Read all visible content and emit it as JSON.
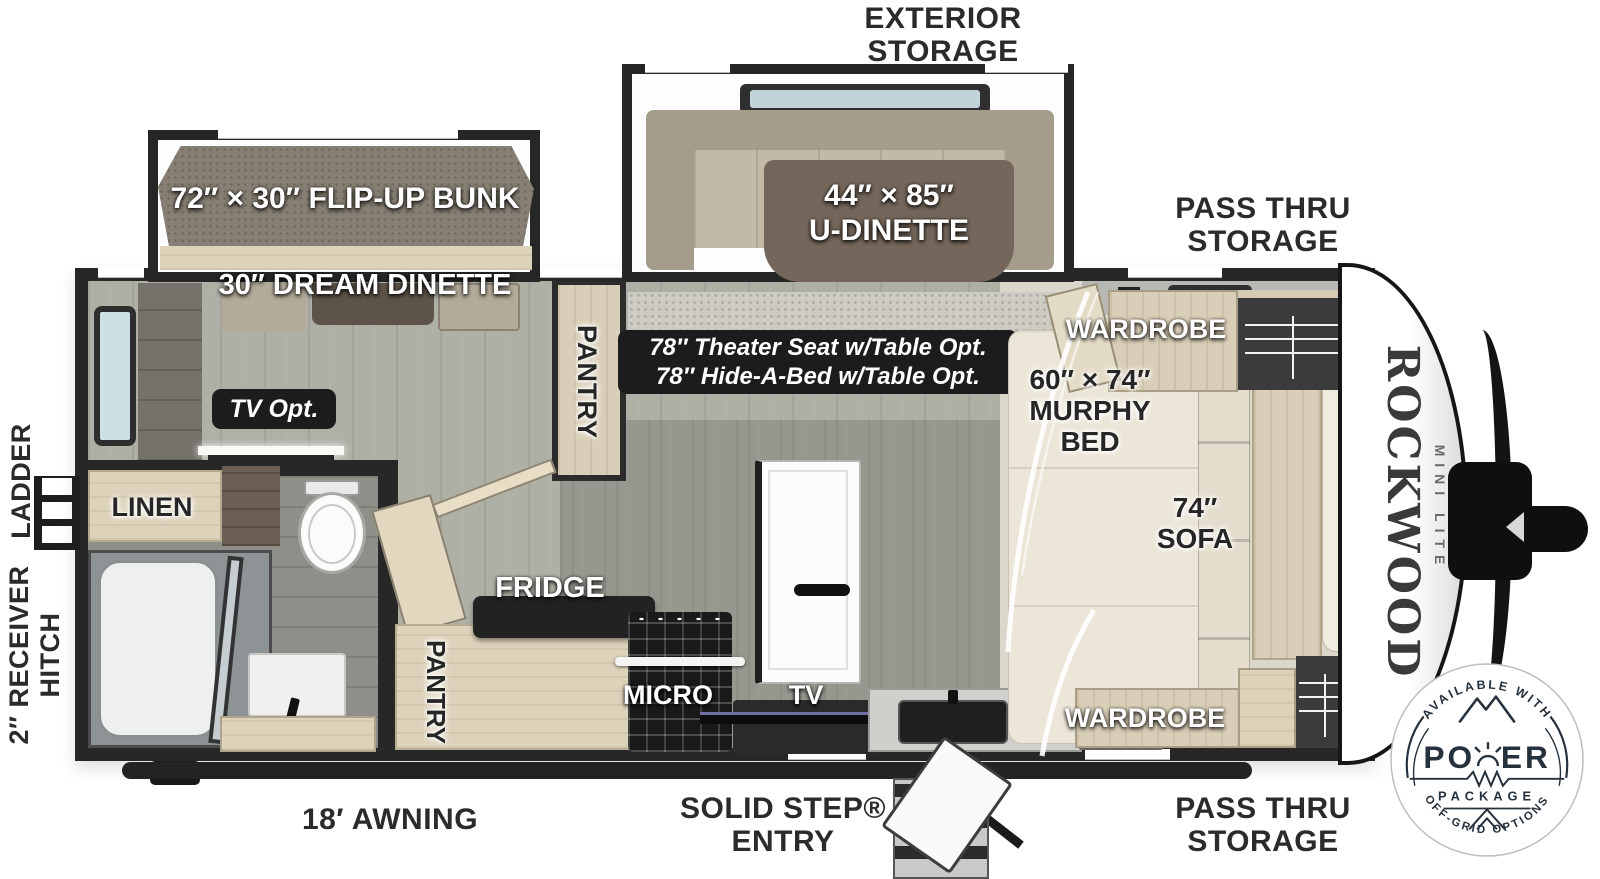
{
  "outside_labels": {
    "exterior_storage": {
      "line1": "EXTERIOR",
      "line2": "STORAGE"
    },
    "pass_thru_top": {
      "line1": "PASS THRU",
      "line2": "STORAGE"
    },
    "pass_thru_bottom": {
      "line1": "PASS THRU",
      "line2": "STORAGE"
    },
    "awning": "18′ AWNING",
    "solid_step": {
      "line1": "SOLID STEP®",
      "line2": "ENTRY"
    },
    "ladder": "LADDER",
    "receiver_hitch": {
      "line1": "2″ RECEIVER",
      "line2": "HITCH"
    }
  },
  "interior_labels": {
    "flip_up_bunk": "72″ × 30″ FLIP-UP BUNK",
    "dream_dinette": "30″ DREAM DINETTE",
    "u_dinette": {
      "line1": "44″ × 85″",
      "line2": "U-DINETTE"
    },
    "options_badge": {
      "line1": "78″ Theater Seat w/Table Opt.",
      "line2": "78″ Hide-A-Bed w/Table Opt."
    },
    "tv_opt": "TV Opt.",
    "pantry_main": "PANTRY",
    "pantry_kitchen": "PANTRY",
    "linen": "LINEN",
    "fridge": "FRIDGE",
    "micro": "MICRO",
    "tv": "TV",
    "wardrobe_top": "WARDROBE",
    "wardrobe_bottom": "WARDROBE",
    "murphy_bed": {
      "line1": "60″ × 74″",
      "line2": "MURPHY",
      "line3": "BED"
    },
    "sofa": {
      "line1": "74″",
      "line2": "SOFA"
    },
    "shelf": "SHELF"
  },
  "brand": {
    "name": "ROCKWOOD",
    "series": "MINI LITE"
  },
  "power_badge": {
    "top_arc": "AVAILABLE WITH",
    "word": "POWER",
    "word_left": "PO",
    "word_right": "ER",
    "sub": "PACKAGE",
    "bottom_arc": "OFF-GRID OPTIONS"
  },
  "colors": {
    "wall": "#272727",
    "label_dark": "#2b2b2b",
    "badge_bg": "#1c1c1c",
    "wood_light": "#ddd3bb",
    "cushion": "#b3aa99",
    "table_brown": "#74665a",
    "mattress_gray": "#8a8177",
    "floor_living": "#aeb0a6",
    "floor_bath": "#8e8f88",
    "carpet_bedroom": "#dbd7ca",
    "glass_blue": "#c2d4da",
    "bed_cream": "#ece6d8",
    "badge_ink": "#25313c"
  }
}
